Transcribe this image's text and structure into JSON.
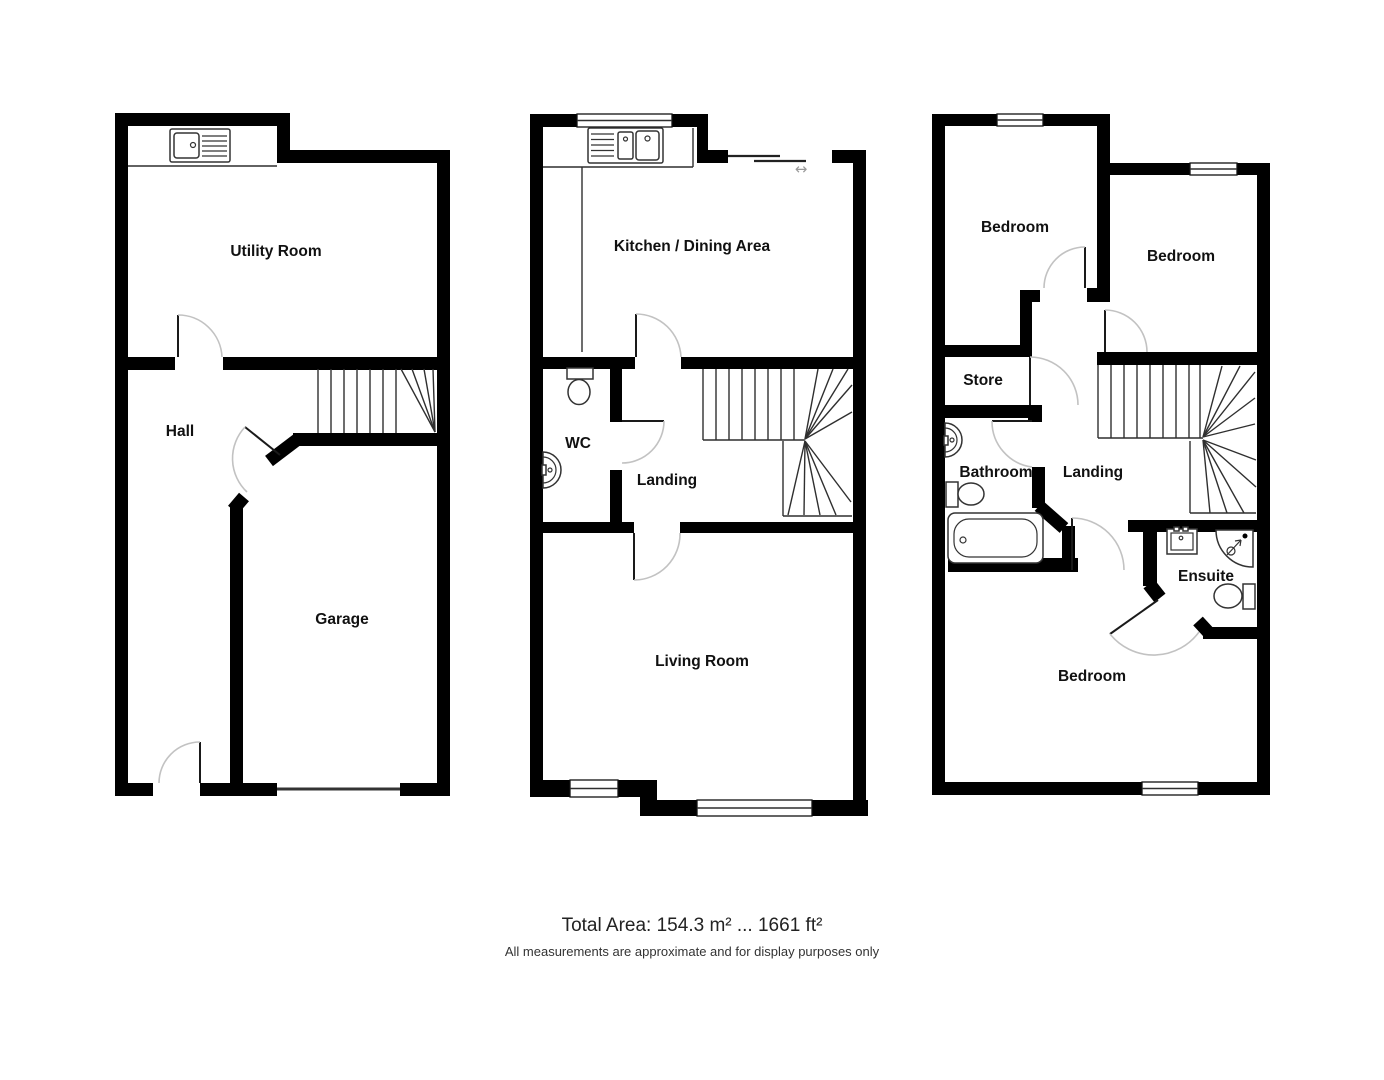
{
  "footer": {
    "total_area": "Total Area: 154.3 m² ... 1661 ft²",
    "disclaimer": "All measurements are approximate and for display purposes only"
  },
  "floors": {
    "ground": {
      "utility_room": "Utility Room",
      "hall": "Hall",
      "garage": "Garage"
    },
    "first": {
      "kitchen_dining": "Kitchen / Dining Area",
      "wc": "WC",
      "landing": "Landing",
      "living_room": "Living Room"
    },
    "second": {
      "bedroom_top_left": "Bedroom",
      "bedroom_top_right": "Bedroom",
      "store": "Store",
      "bathroom": "Bathroom",
      "landing": "Landing",
      "ensuite": "Ensuite",
      "bedroom_bottom": "Bedroom"
    }
  },
  "symbols": {
    "sliding_door_arrow": "↔"
  }
}
